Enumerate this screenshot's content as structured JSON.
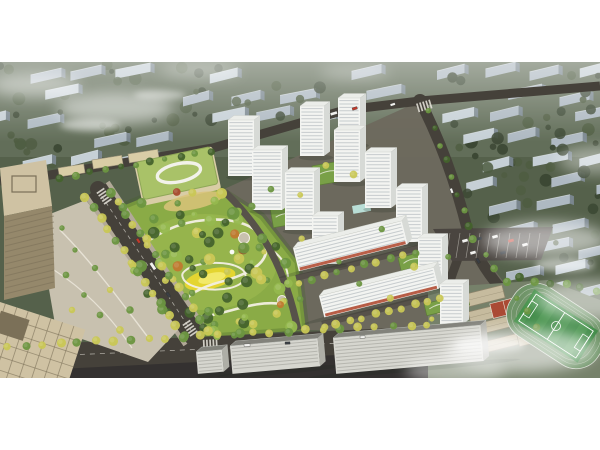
{
  "image": {
    "kind": "aerial architectural rendering of a residential masterplan",
    "regions": {
      "background_city": "hazy rows of mid-rise apartment slabs among dark olive trees",
      "residential_towers": "cluster of white high-rise towers with landscaped green courtyards",
      "retail_slabs": "long mid-rise slabs with red ground-floor shopfronts",
      "central_park": "large park with winding white paths, circular plazas and a yellow lawn",
      "kindergarten": "low building with light-green roof and white loop motif",
      "office_buildings": "tan office blocks with landscaped plaza at lower left",
      "school_campus": "tan-roofed school buildings linked by corridors",
      "sports_field": "green pitch with running track and red courts",
      "parking_lot": "surface car park with parked vehicles",
      "roads": "tree-lined boulevards with scattered cars and buses",
      "fog": "white mist drifting over the corners"
    }
  },
  "palette": {
    "page_bg": "#ffffff",
    "base": "#55614b",
    "base_top": "#6e7a66",
    "bg_tree_dark": "#3c4834",
    "bg_tree": "#4f5d42",
    "bg_block": "#aeb9c2",
    "bg_block_light": "#c6d0d6",
    "bg_block_side": "#7e8b96",
    "road": "#45413a",
    "road_dark": "#343130",
    "road_line": "#d9d6cd",
    "sidewalk": "#b2a998",
    "plaza": "#c8c1af",
    "park_grass": "#8aab46",
    "park_grass_light": "#a3bf55",
    "lawn_yellow": "#e4d531",
    "lawn_yellow_light": "#f2e96a",
    "path": "#f2efe3",
    "plaza_circle": "#b98a5a",
    "tree_dark": "#44632c",
    "tree_green": "#6b9540",
    "tree_light": "#95b84e",
    "tree_yellow": "#c9c755",
    "tree_orange": "#c0792f",
    "tree_red": "#a84a2e",
    "tower_front": "#f3f4f1",
    "tower_side": "#d7dad6",
    "tower_roof": "#ebede9",
    "tower_window": "#9aa4ab",
    "podium": "#79a047",
    "retail_red": "#b4513a",
    "pool": "#b9ded6",
    "kg_roof": "#a9c268",
    "kg_roof_edge": "#8ea757",
    "kg_wall": "#d9cda6",
    "kg_play": "#d9c37a",
    "office_top": "#cfc2a3",
    "office_face": "#95886b",
    "office_grid": "#7b7058",
    "fg_roof": "#82827b",
    "fg_face": "#d6d6cf",
    "fg_side": "#aeaea6",
    "fg_window": "#8f8f88",
    "school_roof": "#c6bb9e",
    "school_edge": "#8f856c",
    "school_ground": "#76816a",
    "field": "#3f8a46",
    "field_light": "#519c54",
    "track": "#6f9468",
    "court_red": "#aa4a34",
    "parking": "#4a4540",
    "car_white": "#f2f2ef",
    "car_red": "#c23a2c",
    "car_dark": "#3a3f45",
    "fog": "#ffffff"
  }
}
